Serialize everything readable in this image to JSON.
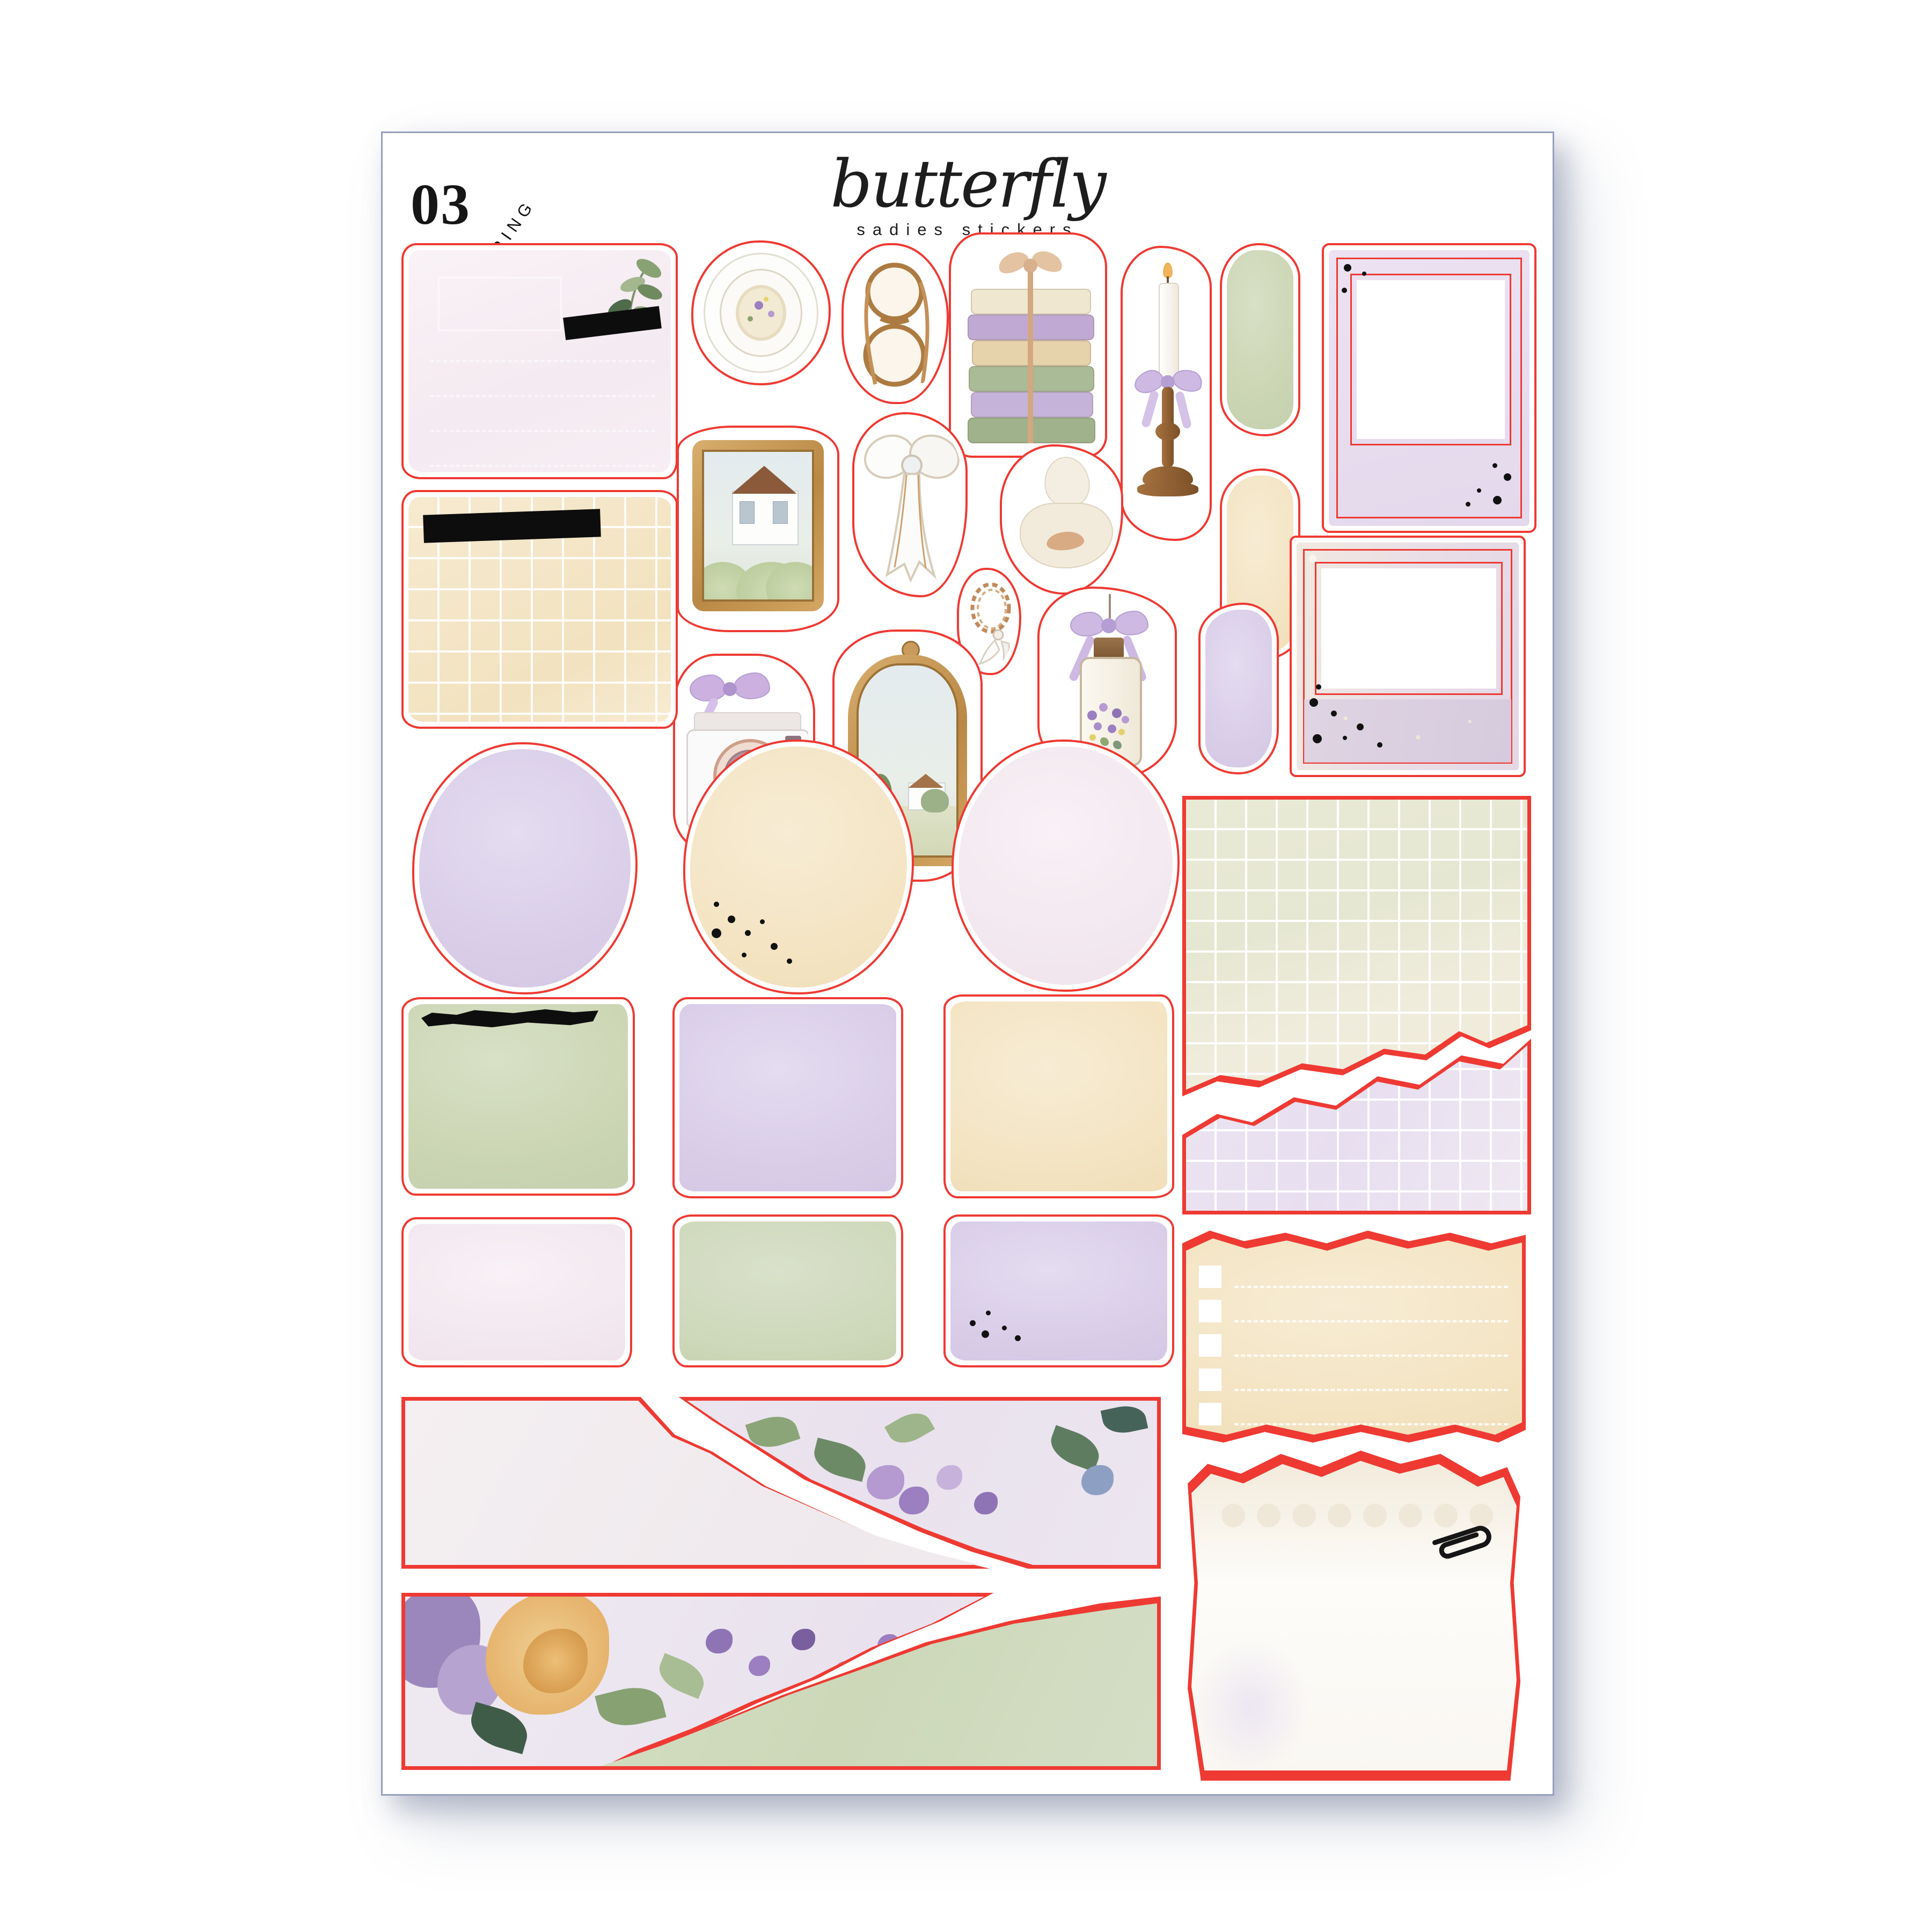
{
  "header": {
    "sheet_number": "03",
    "sheet_category": "LAYERING",
    "brand_name": "butterfly",
    "brand_tagline": "sadies stickers"
  },
  "colors": {
    "cut_line_red": "#ee3a33",
    "sheet_border": "#96a0bd",
    "gold_frame": "#c89b5c",
    "lavender": "#d9cde8",
    "sage_green": "#ccd6b4",
    "cream": "#f3e3c1",
    "blush_pink": "#f4eaf1",
    "black_accent": "#111111"
  },
  "stickers": [
    {
      "id": "pink-journal-note",
      "desc": "blush pink note card with leaf sprig and black washi tape"
    },
    {
      "id": "tan-grid-note",
      "desc": "cream grid note card with black washi tape"
    },
    {
      "id": "coffee-cup",
      "desc": "top view latte with lavender sprigs"
    },
    {
      "id": "folded-glasses",
      "desc": "gold round reading glasses"
    },
    {
      "id": "book-stack-with-bow",
      "desc": "stack of pastel books tied with ribbon bow"
    },
    {
      "id": "candlestick-with-bow",
      "desc": "white taper candle on wooden candlestick with lavender bow"
    },
    {
      "id": "green-paint-swatch",
      "desc": "sage watercolor brush swatch"
    },
    {
      "id": "lavender-polaroid-frame",
      "desc": "portrait polaroid frame with black dots"
    },
    {
      "id": "gold-frame-house",
      "desc": "ornate gold frame with cottage and flower garden"
    },
    {
      "id": "white-bow",
      "desc": "white ribbon bow with long tails"
    },
    {
      "id": "plaster-bust",
      "desc": "stone bust statue with ribbon bow"
    },
    {
      "id": "cream-paint-swatch",
      "desc": "cream watercolor brush swatch"
    },
    {
      "id": "chain-bracelet",
      "desc": "gold chain bracelet with wing charm"
    },
    {
      "id": "lace-polaroid-frame",
      "desc": "landscape lace polaroid frame with black dots"
    },
    {
      "id": "lavender-lantern",
      "desc": "glass lantern with lavender bow and flowers"
    },
    {
      "id": "lavender-paint-swatch",
      "desc": "lavender watercolor brush swatch"
    },
    {
      "id": "camera-with-bow",
      "desc": "white camera with rose gold lens and lavender bow"
    },
    {
      "id": "gold-mirror-landscape",
      "desc": "ornate gold mirror frame with countryside scene"
    },
    {
      "id": "green-lace-grid-paper",
      "desc": "torn green lace grid journal paper"
    },
    {
      "id": "lavender-watercolor-circle",
      "desc": "lavender watercolor circle"
    },
    {
      "id": "cream-watercolor-circle",
      "desc": "cream watercolor circle with black dots"
    },
    {
      "id": "pink-watercolor-circle",
      "desc": "pale pink watercolor circle"
    },
    {
      "id": "lavender-grid-paper",
      "desc": "torn lavender grid journal paper"
    },
    {
      "id": "green-watercolor-square",
      "desc": "sage square with black brush stroke"
    },
    {
      "id": "lavender-watercolor-square",
      "desc": "lavender watercolor square"
    },
    {
      "id": "cream-watercolor-square",
      "desc": "cream watercolor square"
    },
    {
      "id": "cream-checklist-paper",
      "desc": "torn cream checklist paper with checkboxes"
    },
    {
      "id": "pink-watercolor-rect",
      "desc": "blush watercolor rectangle"
    },
    {
      "id": "green-watercolor-rect",
      "desc": "sage watercolor rectangle"
    },
    {
      "id": "lavender-watercolor-rect",
      "desc": "lavender watercolor rectangle with black dots"
    },
    {
      "id": "torn-strip-pale-and-floral",
      "desc": "two torn paper strips, pale texture and purple floral"
    },
    {
      "id": "note-paper-with-paperclip",
      "desc": "punched note paper with black paperclip"
    },
    {
      "id": "torn-strip-floral-and-green",
      "desc": "two torn paper strips, rose floral and sage green"
    }
  ]
}
